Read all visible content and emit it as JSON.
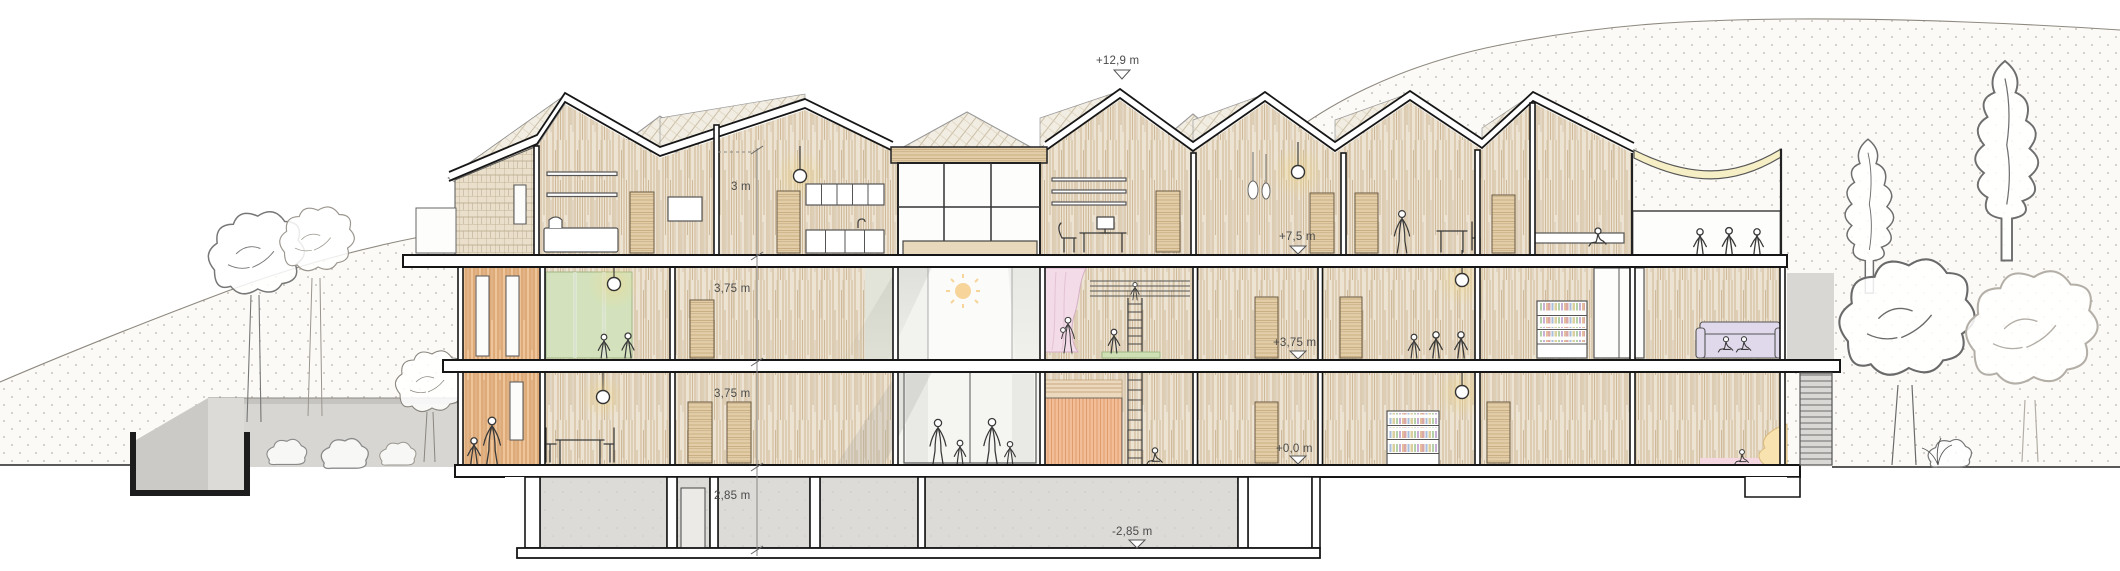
{
  "drawing": {
    "type": "architectural cross-section of three-storey timber building with basement",
    "level_markers": [
      {
        "id": "ridge",
        "text": "+12,9 m"
      },
      {
        "id": "floor2",
        "text": "+7,5 m"
      },
      {
        "id": "floor1",
        "text": "+3,75 m"
      },
      {
        "id": "ground",
        "text": "+0,0 m"
      },
      {
        "id": "basement",
        "text": "-2,85 m"
      }
    ],
    "height_dims": [
      {
        "id": "attic-height",
        "text": "3 m"
      },
      {
        "id": "floor1-height",
        "text": "3,75 m"
      },
      {
        "id": "ground-height",
        "text": "3,75 m"
      },
      {
        "id": "basement-height",
        "text": "2,85 m"
      }
    ],
    "palette": {
      "wood_wall": "#ece3d2",
      "wood_warm_glow": "#f1d78a",
      "roof_hatch": "#f2ede2",
      "shingle": "#eadfcb",
      "corridor_orange": "#eec49a",
      "salmon_wall": "#f2bd97",
      "green_panels": "#d3e2bc",
      "pink_curtain": "#f4dbe8",
      "lavender_sofa": "#e0d9ec",
      "awning_yellow": "#f6eec4",
      "curtain_yellow": "#f8e3b0",
      "floor_pink": "#f5d7e2",
      "concrete": "#dcdbd8",
      "sun": "#f6d49a"
    }
  }
}
